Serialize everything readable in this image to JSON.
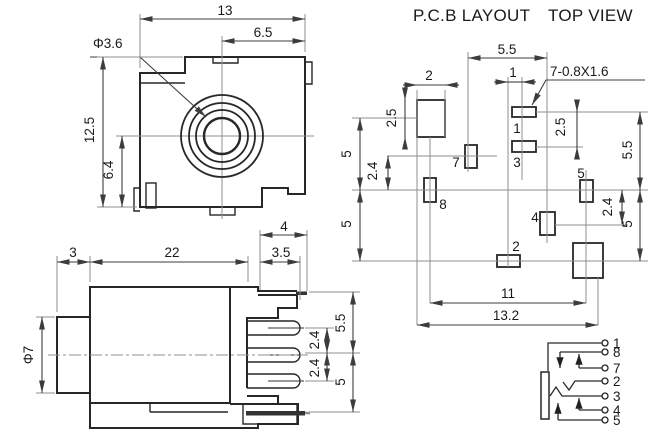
{
  "colors": {
    "line": "#272727",
    "dim": "#3c3c3c",
    "ext": "#8f8f8f",
    "text": "#1a1a1a",
    "bg": "#ffffff"
  },
  "titles": {
    "pcb_layout": "P.C.B LAYOUT",
    "top_view": "TOP VIEW"
  },
  "front_view": {
    "dim_width": "13",
    "dim_half_width": "6.5",
    "dim_hole": "Φ3.6",
    "dim_height": "12.5",
    "dim_lower_height": "6.4"
  },
  "side_view": {
    "dim_bushing": "3",
    "dim_body": "22",
    "dim_pin_top": "4",
    "dim_pin": "3.5",
    "dim_barrel": "Φ7",
    "dim_top_pitch": "5.5",
    "dim_pitch_a": "2.4",
    "dim_pitch_b": "2.4",
    "dim_bottom_pitch": "5"
  },
  "pcb_layout": {
    "dim_top_pitch": "5.5",
    "dim_pad_w": "2",
    "dim_pad_h": "2.5",
    "dim_col": "1",
    "note_holes": "7-0.8X1.6",
    "dim_row13": "2.5",
    "dim_right_upper": "5.5",
    "dim_right_24": "2.4",
    "dim_right_lower": "5",
    "dim_left_upper": "5",
    "dim_left_24": "2.4",
    "dim_left_lower": "5",
    "dim_span_inner": "11",
    "dim_span_outer": "13.2",
    "pads": {
      "p1": "1",
      "p2": "2",
      "p3": "3",
      "p4": "4",
      "p5": "5",
      "p7": "7",
      "p8": "8"
    }
  },
  "schematic": {
    "t1": "1",
    "t8": "8",
    "t7": "7",
    "t2": "2",
    "t3": "3",
    "t4": "4",
    "t5": "5"
  }
}
